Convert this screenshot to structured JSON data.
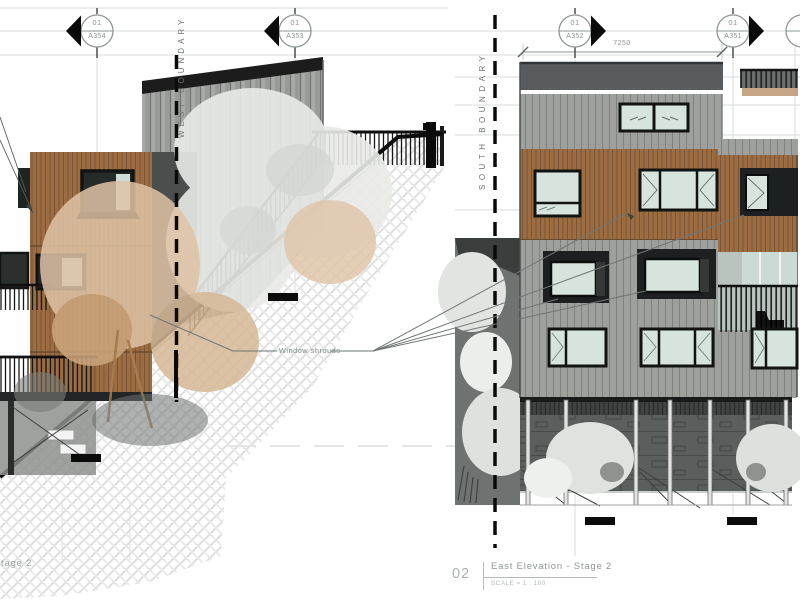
{
  "sheet": {
    "kind": "architectural elevation drawing",
    "background": "#ffffff"
  },
  "left_view": {
    "boundary_label": "WEST BOUNDARY",
    "markers": [
      {
        "num": "01",
        "sheet": "A354"
      },
      {
        "num": "01",
        "sheet": "A353"
      }
    ],
    "annotation": "Window shrouds",
    "title_partial": "tage 2"
  },
  "right_view": {
    "boundary_label": "SOUTH BOUNDARY",
    "markers": [
      {
        "num": "01",
        "sheet": "A352"
      },
      {
        "num": "01",
        "sheet": "A351"
      }
    ],
    "dimension": "7250",
    "title_number": "02",
    "title": "East Elevation - Stage 2",
    "scale": "SCALE = 1 : 100"
  },
  "colors": {
    "timber_cladding": "#9c6c42",
    "timber_joint": "#7c5432",
    "grey_cladding": "#9da09d",
    "grey_joint": "#7f827d",
    "parapet": "#595c5e",
    "glass": "#d7e3dd",
    "dark_glass": "#262b2a",
    "window_frame": "#121413",
    "shroud": "#1d2020",
    "undercroft": "#5a5e5c",
    "hatch_line": "#dedede",
    "gridline": "#d9dcdb",
    "boundary_dash": "#0a0a0a",
    "annotation_grey": "#8a918f",
    "foliage_tan": "#dfc3a6",
    "foliage_light": "#e9ebe8"
  }
}
